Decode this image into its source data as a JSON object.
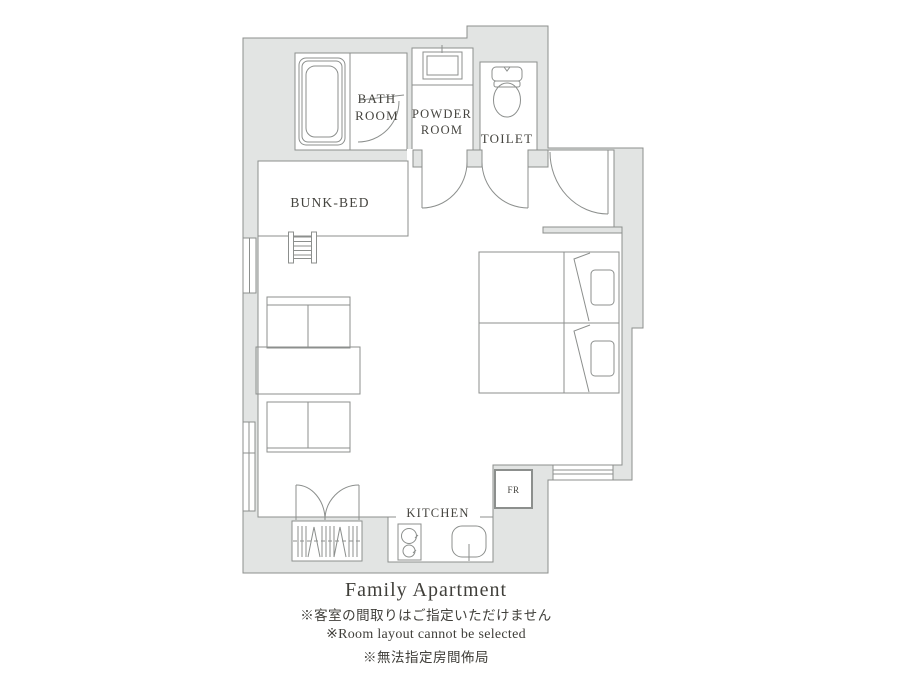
{
  "palette": {
    "wall_fill": "#e2e4e3",
    "line_color": "#8c8f8d",
    "text_color": "#45443f"
  },
  "floorplan": {
    "labels": {
      "bath_room": [
        "BATH",
        "ROOM"
      ],
      "powder_room": [
        "POWDER",
        "ROOM"
      ],
      "toilet": "TOILET",
      "bunk_bed": "BUNK-BED",
      "kitchen": "KITCHEN",
      "fridge": "FR"
    }
  },
  "caption": {
    "title": "Family Apartment",
    "note_ja": "※客室の間取りはご指定いただけません",
    "note_en": "※Room layout cannot be selected",
    "note_zh": "※無法指定房間佈局"
  }
}
